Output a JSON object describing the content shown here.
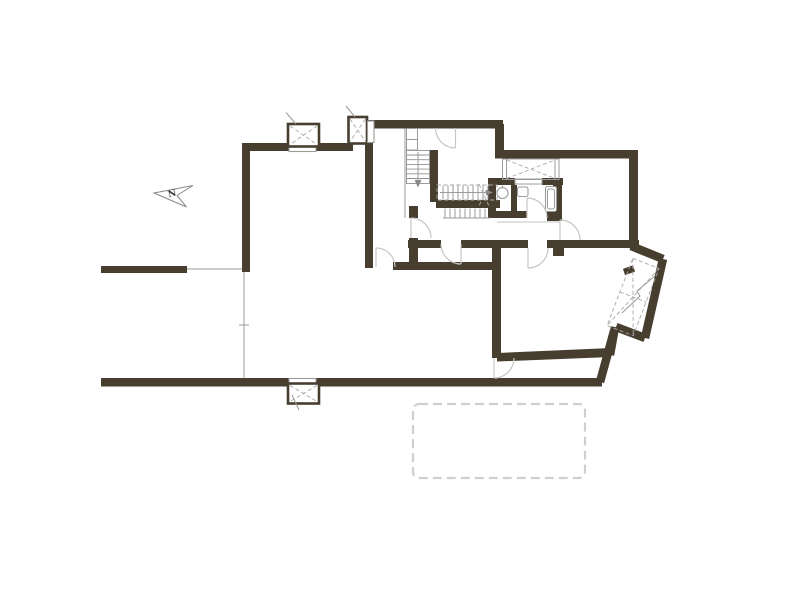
{
  "drawing": {
    "kind": "architectural floor plan",
    "north_arrow": {
      "label": "N"
    }
  },
  "colors": {
    "background": "#ffffff",
    "wall": "#473E30",
    "thin": "#9b9b99",
    "door_arc": "#c6c6c4",
    "dashed": "#a8a8a6",
    "tread": "#90908e",
    "pool_dash": "#cfcfcd"
  }
}
